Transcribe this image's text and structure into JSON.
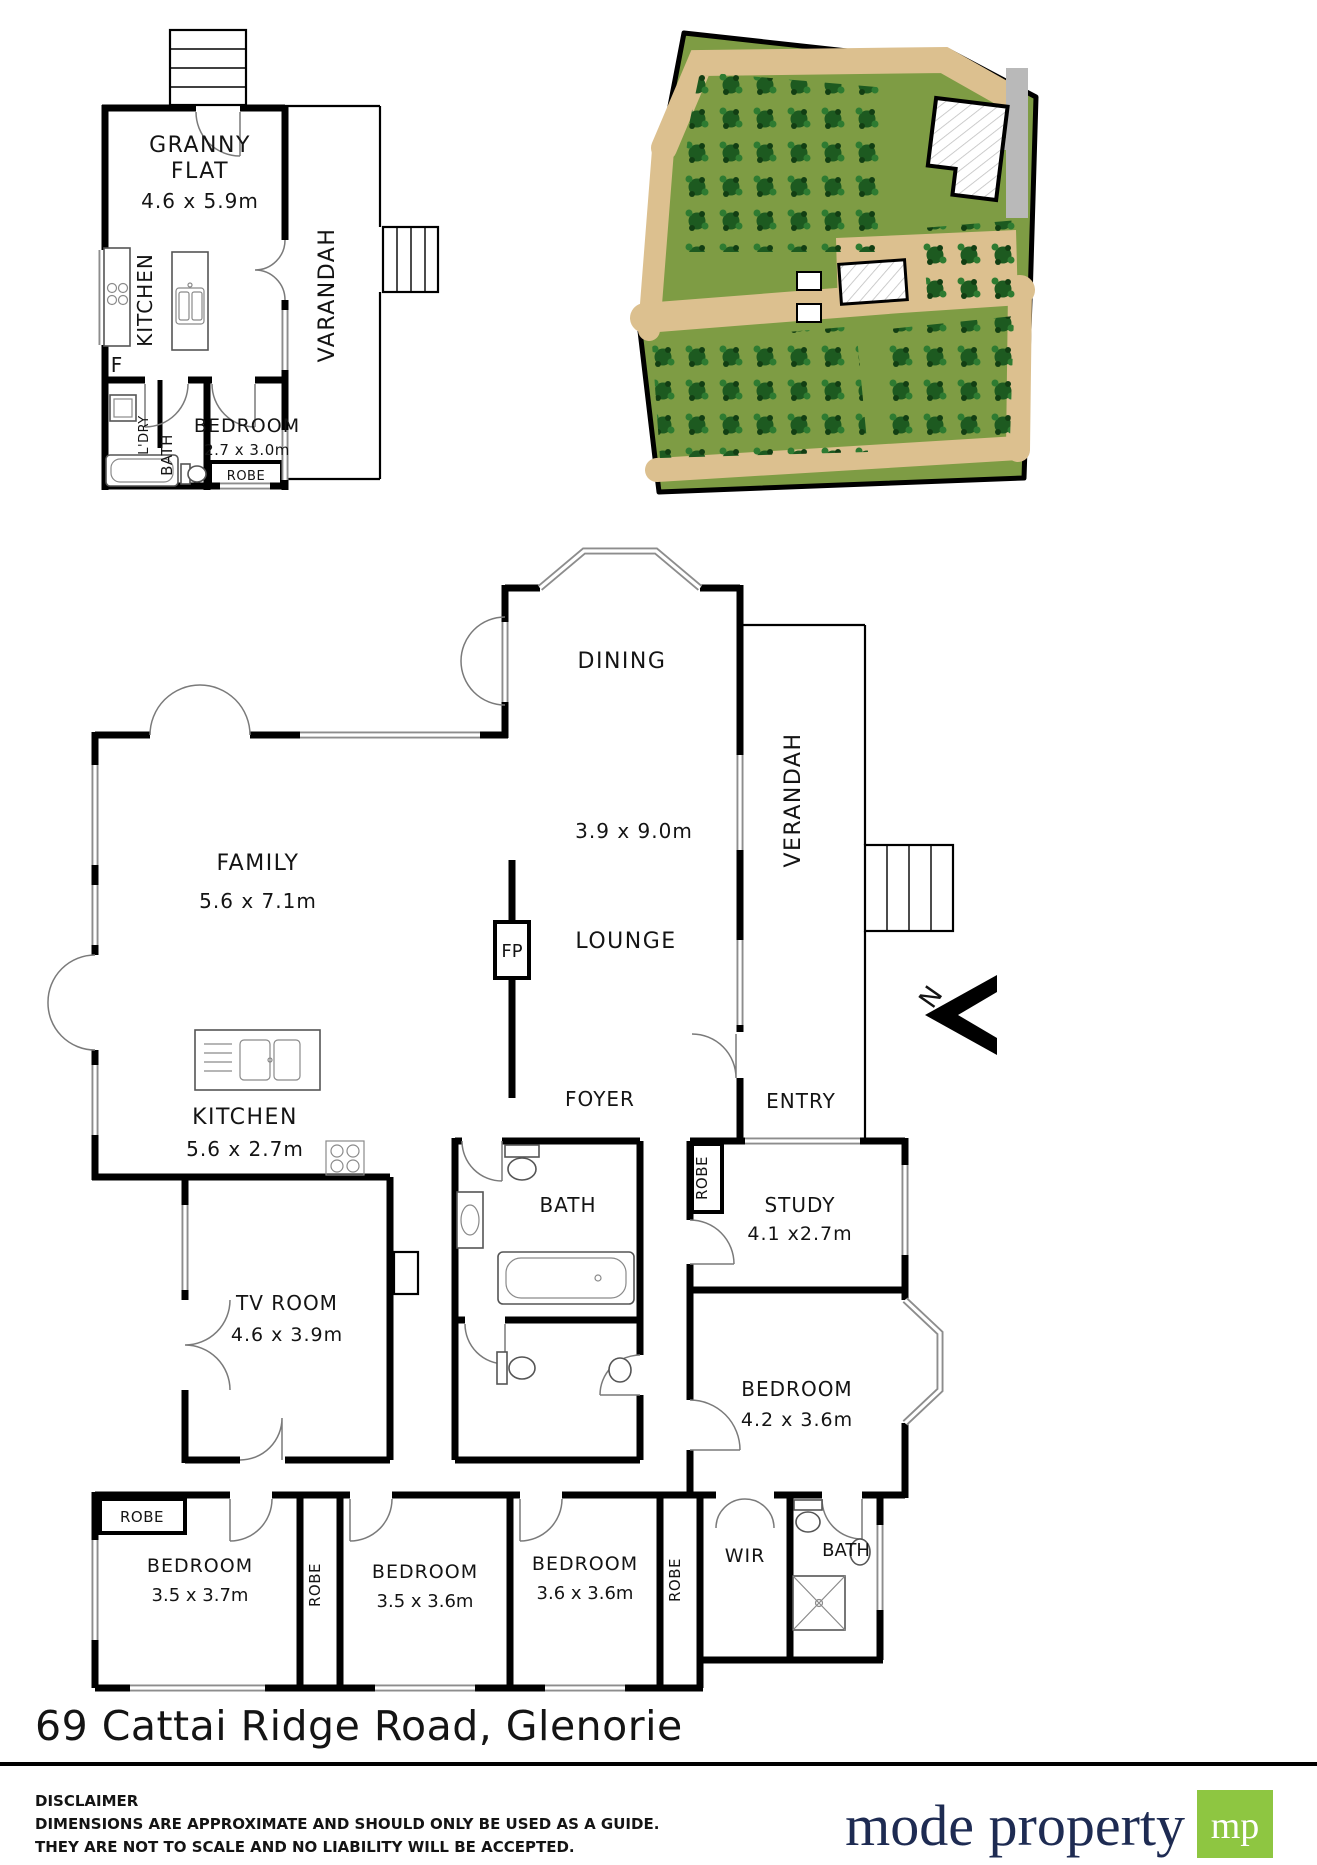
{
  "granny": {
    "title1": "GRANNY",
    "title2": "FLAT",
    "dims": "4.6 x 5.9m",
    "kitchen": "KITCHEN",
    "fridge": "F",
    "laundry": "L'DRY",
    "bath": "BATH",
    "bedroom": "BEDROOM",
    "bedroom_dims": "2.7 x 3.0m",
    "robe": "ROBE",
    "verandah": "VARANDAH"
  },
  "main": {
    "dining": "DINING",
    "dining_lounge_dims": "3.9 x 9.0m",
    "lounge": "LOUNGE",
    "fireplace": "FP",
    "family": "FAMILY",
    "family_dims": "5.6 x 7.1m",
    "kitchen": "KITCHEN",
    "kitchen_dims": "5.6 x 2.7m",
    "foyer": "FOYER",
    "entry": "ENTRY",
    "verandah": "VERANDAH",
    "robe_entry": "ROBE",
    "study": "STUDY",
    "study_dims": "4.1 x2.7m",
    "bath_main": "BATH",
    "tv_room": "TV ROOM",
    "tv_room_dims": "4.6 x 3.9m",
    "bedroom_master": "BEDROOM",
    "bedroom_master_dims": "4.2 x 3.6m",
    "robe_box": "ROBE",
    "bedroom1": "BEDROOM",
    "bedroom1_dims": "3.5 x 3.7m",
    "robe_strip1": "ROBE",
    "bedroom2": "BEDROOM",
    "bedroom2_dims": "3.5 x 3.6m",
    "bedroom3": "BEDROOM",
    "bedroom3_dims": "3.6 x 3.6m",
    "robe_strip2": "ROBE",
    "wir": "WIR",
    "bath_ensuite": "BATH"
  },
  "compass": {
    "north": "N"
  },
  "footer": {
    "address": "69 Cattai Ridge Road, Glenorie",
    "disclaimer_title": "DISCLAIMER",
    "disclaimer_line1": "DIMENSIONS ARE APPROXIMATE AND SHOULD ONLY BE USED AS A GUIDE.",
    "disclaimer_line2": "THEY ARE NOT TO SCALE AND NO LIABILITY WILL BE ACCEPTED.",
    "brand": "mode property",
    "brand_mark": "mp"
  },
  "colors": {
    "brand_navy": "#1e2b52",
    "brand_green": "#8ec641",
    "site_green": "#7e9c44",
    "path_tan": "#dcc08f",
    "tree_green": "#1d5a20"
  }
}
